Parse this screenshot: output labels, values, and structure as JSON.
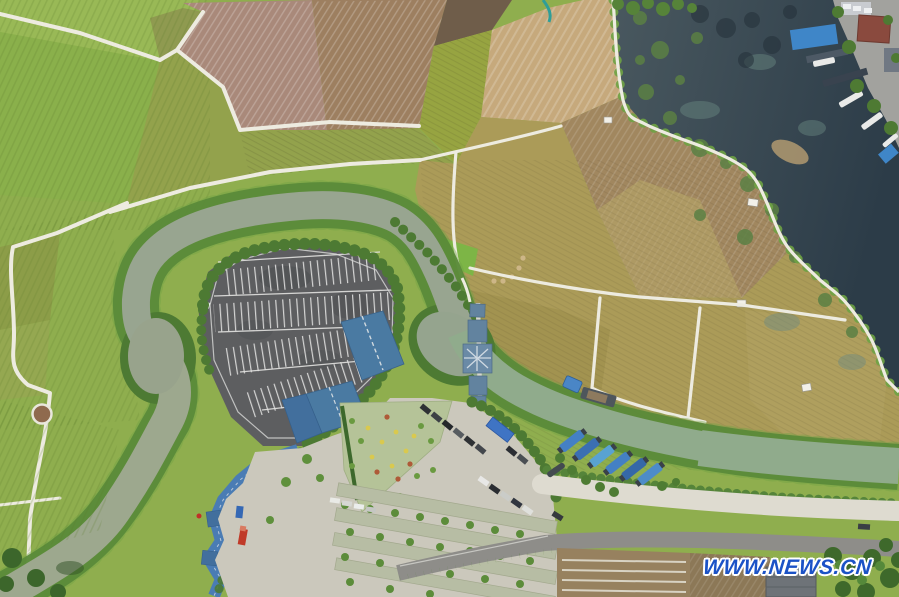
{
  "image": {
    "type": "aerial-photograph",
    "description": "Bird's-eye drone view of countryside scenery: green rice paddies and harvested tan fields divided by white footpaths, a meandering river looping around a tree-ringed visitor parking lot, a blue-roofed covered bridge over the river, a canal with blue-tarp moored boats, a concrete visitor plaza with flower gardens and parked cars, a dark lake with a dock village at top right, and a country road along the bottom.",
    "width_px": 899,
    "height_px": 597
  },
  "watermark": {
    "text": "WWW.NEWS.CN",
    "color": "#1b52c6",
    "outline_color": "#ffffff"
  },
  "scene": {
    "features": [
      "green-rice-paddies",
      "pink-brown-plowed-fields",
      "tan-harvested-fields",
      "khaki-field-parcels",
      "white-field-paths",
      "winding-river",
      "riverside-tree-bands",
      "parking-lot-with-white-stalls",
      "blue-roof-buildings",
      "covered-bridge-with-star-pavilion",
      "zigzag-blue-corridor",
      "visitor-plaza",
      "flower-garden",
      "garden-strips-with-trees",
      "parked-cars",
      "blue-bus",
      "red-truck",
      "canal-with-moored-boats",
      "blue-tarp-boats",
      "cargo-barge",
      "dark-lake-with-vegetation-patches",
      "dock-village",
      "white-boats",
      "white-embankment",
      "country-road",
      "mulched-brown-fields",
      "gray-roof-building",
      "tree-clusters",
      "round-lookout-platform",
      "hay-bales",
      "field-huts"
    ]
  },
  "palette": {
    "base-green": "#8fae4e",
    "field-green-light": "#99b956",
    "field-green-mid": "#8ab04b",
    "field-olive-band": "#93a24c",
    "field-pink": "#a9897a",
    "field-brown": "#9d7f60",
    "field-dark-tilled": "#6f5d4a",
    "field-green-wedge": "#97a441",
    "field-tan": "#c6a97c",
    "field-brown-wedge": "#a1875f",
    "field-khaki": "#ab9b58",
    "parcel-bright-green": "#7db546",
    "lake-deep": "#2c3c48",
    "lake-edge": "#49585f",
    "veg-patch": "#5b8044",
    "river-water": "#98a590",
    "canal-water": "#90ab8c",
    "tree-dark": "#4d7a33",
    "tree-bright": "#6ea244",
    "hedge-green": "#55843a",
    "path-white": "#edebe0",
    "parking-asphalt": "#5d5e60",
    "stall-line-white": "#e8e8e6",
    "plaza-concrete": "#cbc8bc",
    "roof-blue": "#4a7aa2",
    "roof-blue-dark": "#426f9d",
    "corridor-blue": "#4a7cb4",
    "bridge-roof": "#62839f",
    "embankment-white": "#dedbd0",
    "road-gray": "#8e8d89",
    "boat-tarp-blue": "#4480c4",
    "boat-tarp-light": "#59a2d2",
    "boat-hull-dark": "#3a4148",
    "bus-blue": "#3f74c4",
    "truck-red": "#c03a28",
    "dock-building-red": "#8a4a3e",
    "roof-gray": "#6e7378",
    "flower-yellow": "#d9c94e",
    "flower-red": "#ae5a38",
    "watermark-blue": "#1b52c6"
  }
}
